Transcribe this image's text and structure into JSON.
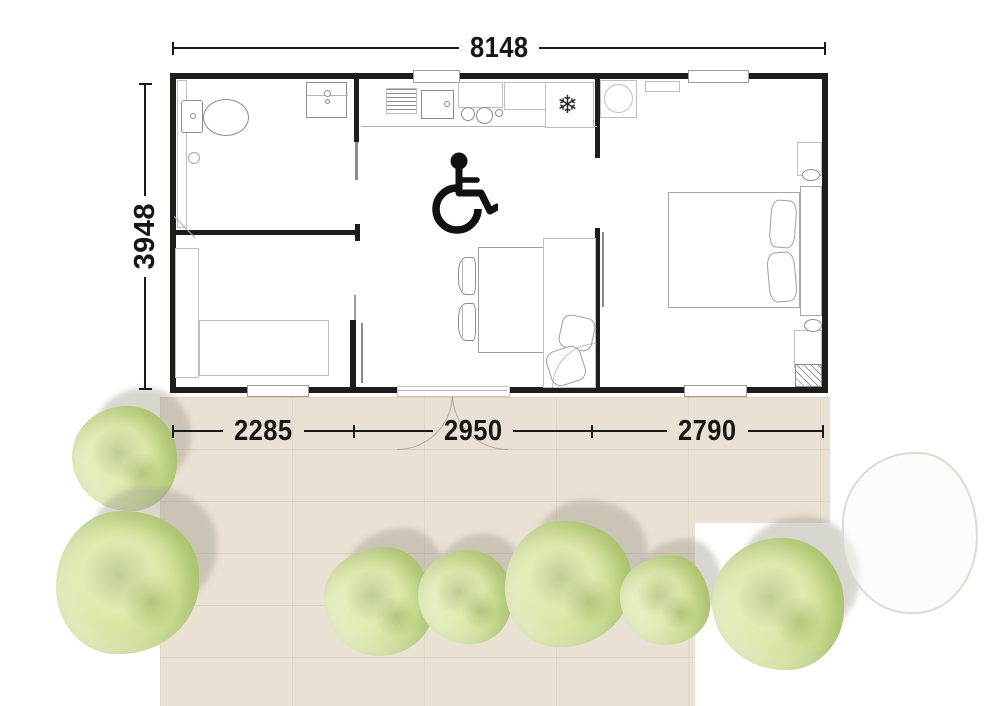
{
  "dimensions": {
    "width_total": "8148",
    "depth_total": "3948",
    "bottom_segments": [
      "2285",
      "2950",
      "2790"
    ]
  },
  "symbols": {
    "fridge_snowflake": "❄",
    "accessibility": "wheelchair-icon"
  },
  "colors": {
    "wall": "#1d1d1b",
    "terrace": "#e9e1d4",
    "tree_green": "#c6da87",
    "dimension_text": "#161616"
  }
}
